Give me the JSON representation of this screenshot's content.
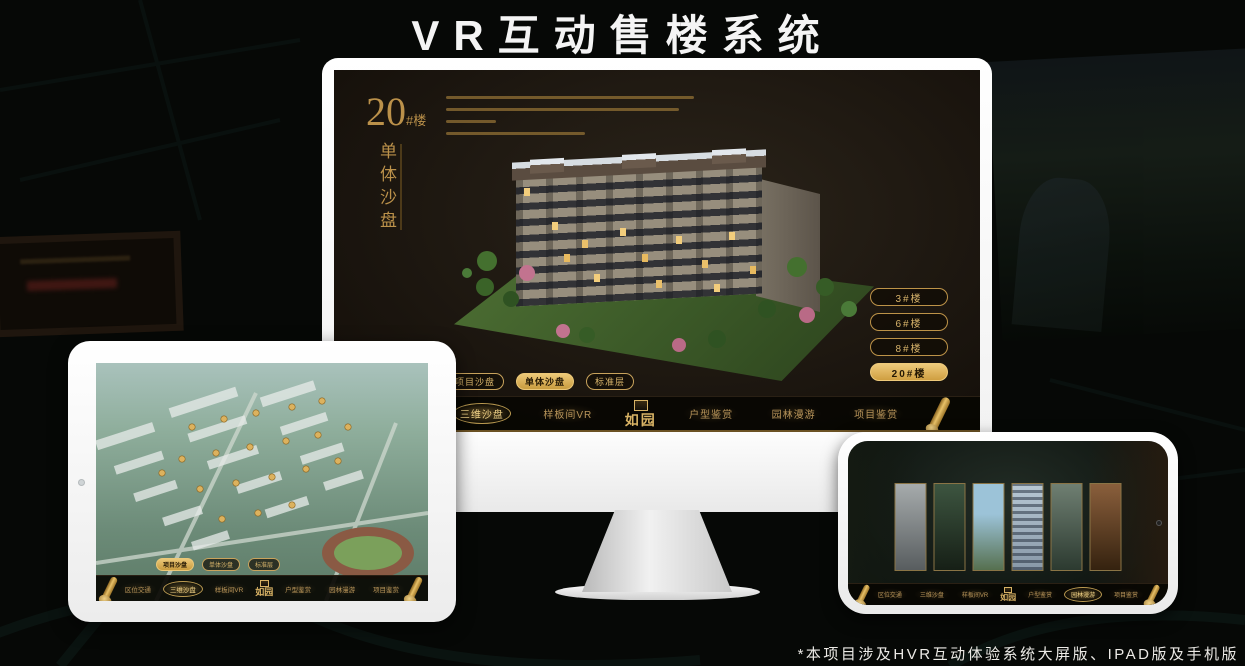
{
  "page": {
    "title": "VR互动售楼系统",
    "footnote": "*本项目涉及HVR互动体验系统大屏版、IPAD版及手机版"
  },
  "colors": {
    "gold": "#c9a35c",
    "gold_bright": "#eeca7b",
    "screen_bg": "#1d1710"
  },
  "tabs": [
    {
      "label": "项目沙盘"
    },
    {
      "label": "单体沙盘"
    },
    {
      "label": "标准层"
    }
  ],
  "nav": {
    "logo": "如园",
    "items_left": [
      {
        "label": "区位交通"
      },
      {
        "label": "三维沙盘"
      },
      {
        "label": "样板间VR"
      }
    ],
    "items_right": [
      {
        "label": "户型鉴赏"
      },
      {
        "label": "园林漫游"
      },
      {
        "label": "项目鉴赏"
      }
    ]
  },
  "monitor": {
    "title_number": "20",
    "title_suffix": "#楼",
    "title_vertical": "单体沙盘",
    "active_tab_index": 1,
    "active_nav": "三维沙盘",
    "active_floor": "20#楼",
    "floor_buttons": [
      {
        "label": "3#楼"
      },
      {
        "label": "6#楼"
      },
      {
        "label": "8#楼"
      },
      {
        "label": "20#楼"
      }
    ]
  },
  "tablet": {
    "active_tab_index": 0,
    "active_nav": "三维沙盘"
  },
  "phone": {
    "active_nav": "园林漫游"
  }
}
